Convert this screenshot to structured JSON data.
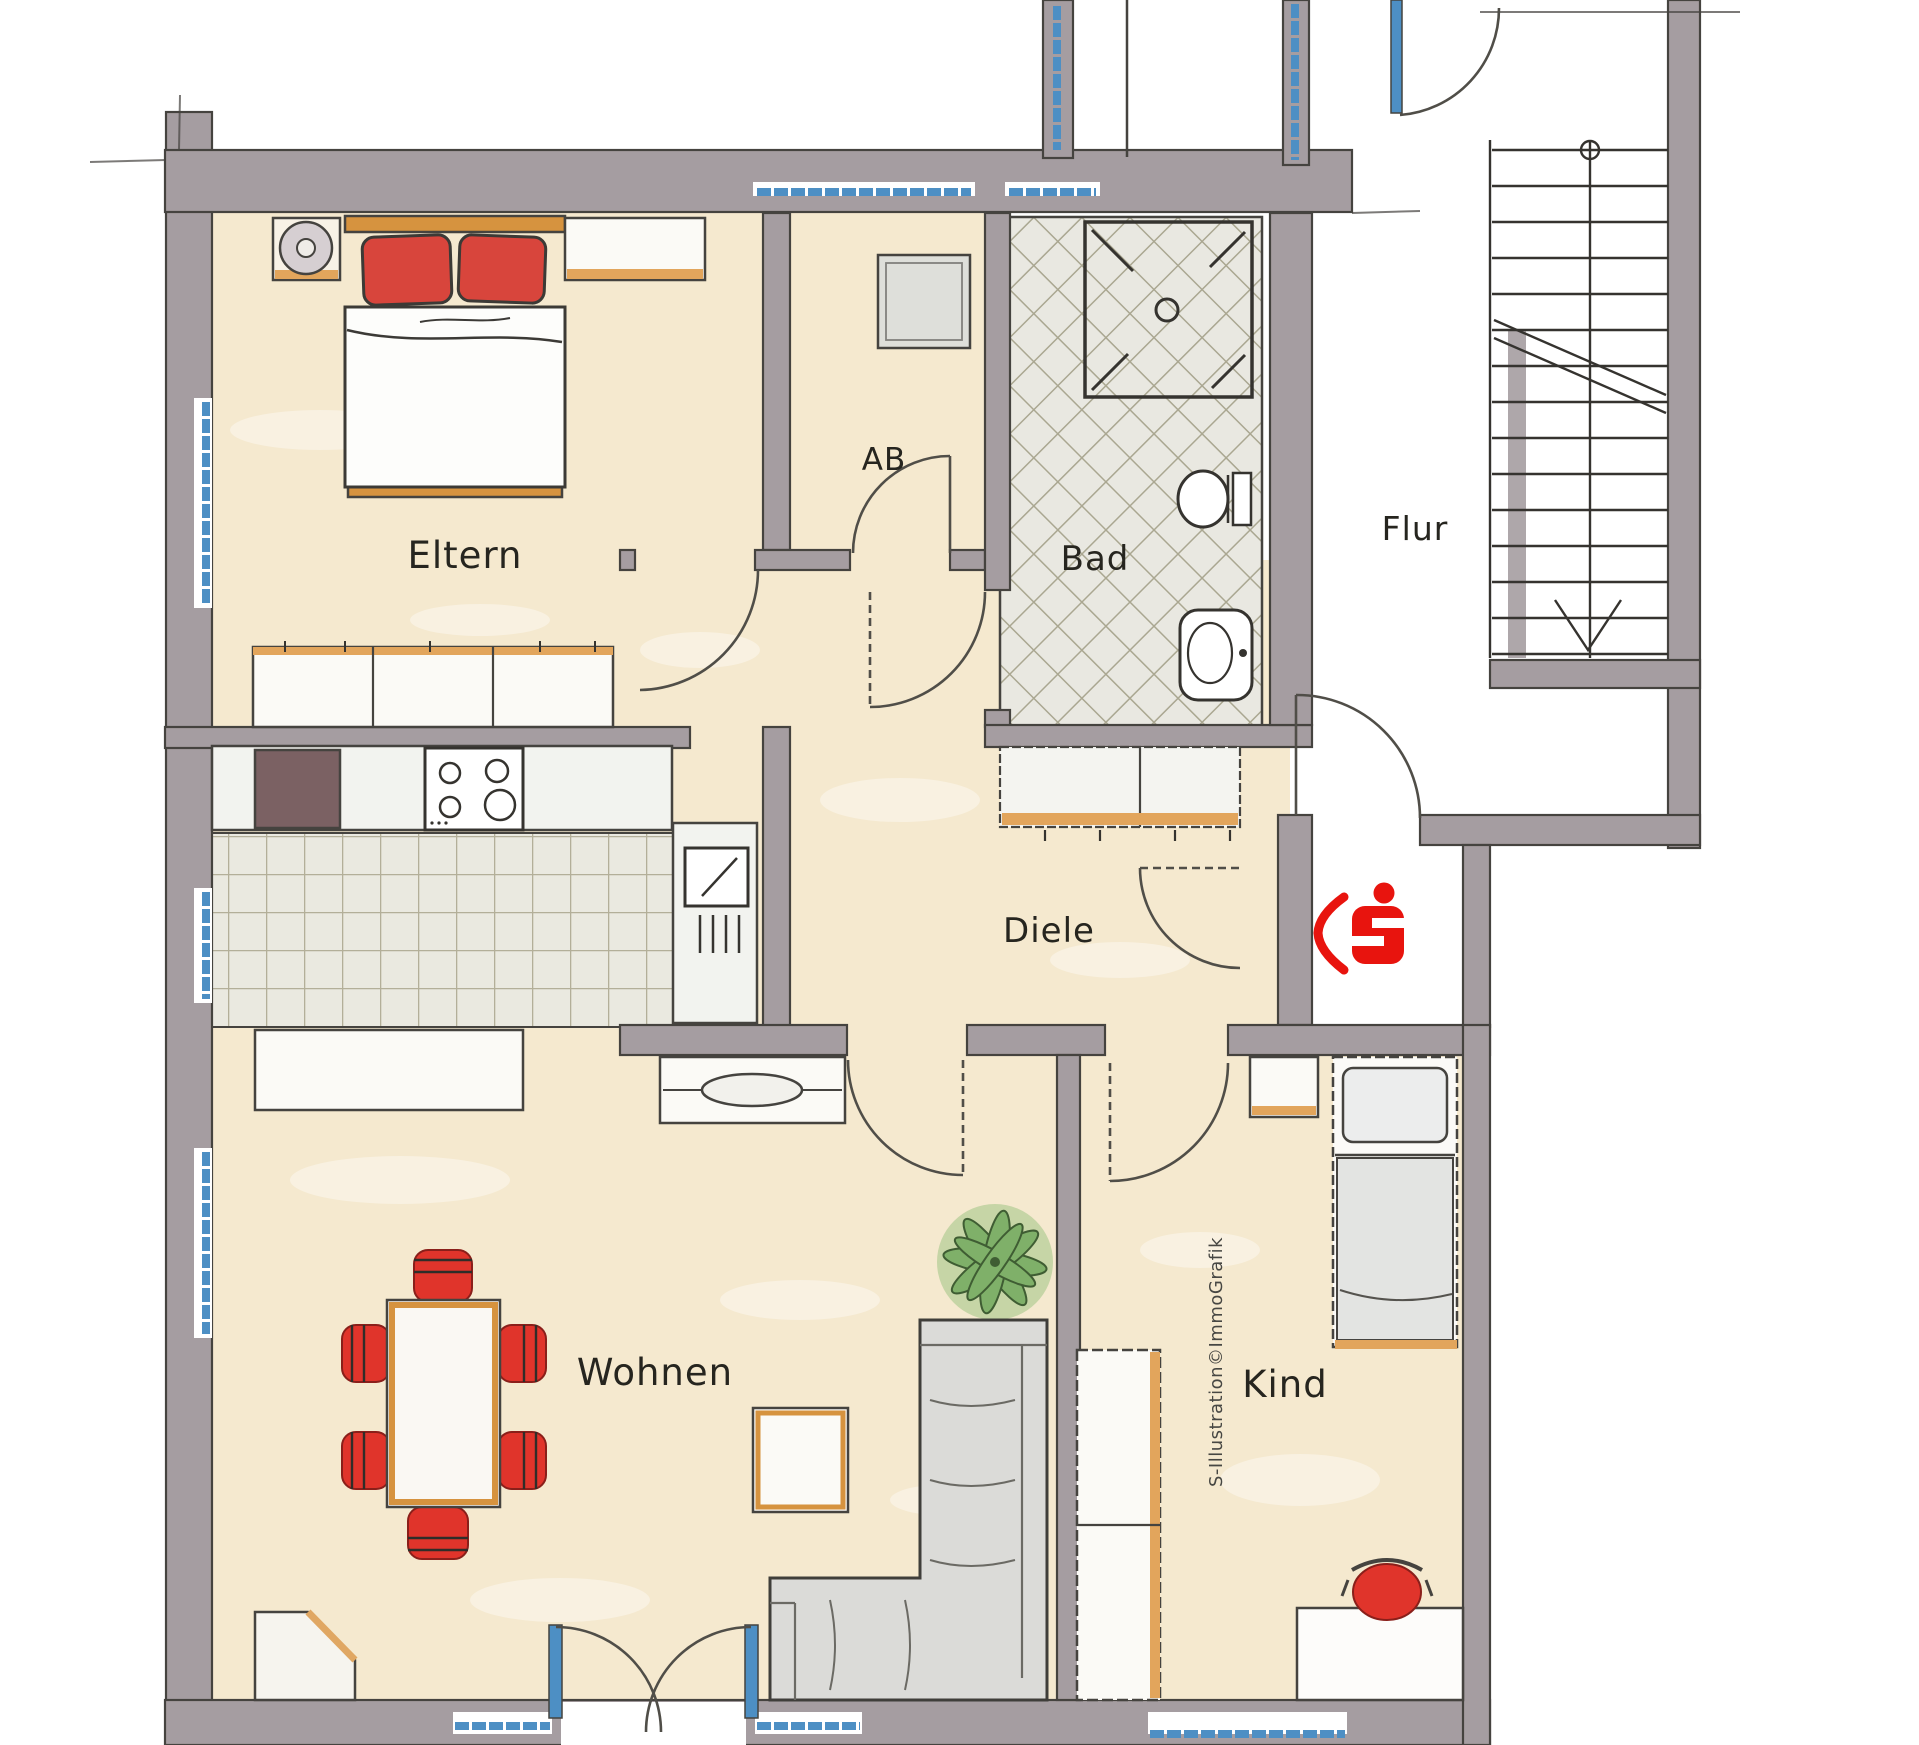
{
  "rooms": {
    "eltern": {
      "label": "Eltern"
    },
    "ab": {
      "label": "AB"
    },
    "bad": {
      "label": "Bad"
    },
    "flur": {
      "label": "Flur"
    },
    "diele": {
      "label": "Diele"
    },
    "wohnen": {
      "label": "Wohnen"
    },
    "kind": {
      "label": "Kind"
    }
  },
  "watermark": {
    "text": "S-Illustration©ImmoGrafik"
  },
  "logo": {
    "brand": "Sparkasse",
    "meaning": "apartment-entrance-marker"
  },
  "colors": {
    "accent_red": "#e8140e",
    "furniture_red": "#e0342b",
    "pillow_red": "#d8453c",
    "wall_gray": "#a59da1",
    "floor_beige": "#f5e9cf",
    "window_blue": "#4d8fc4",
    "wood_orange": "#d6933f",
    "tile_line": "#b3af99",
    "sofa_gray": "#dbdbd8",
    "sketch_line": "#45433f"
  }
}
